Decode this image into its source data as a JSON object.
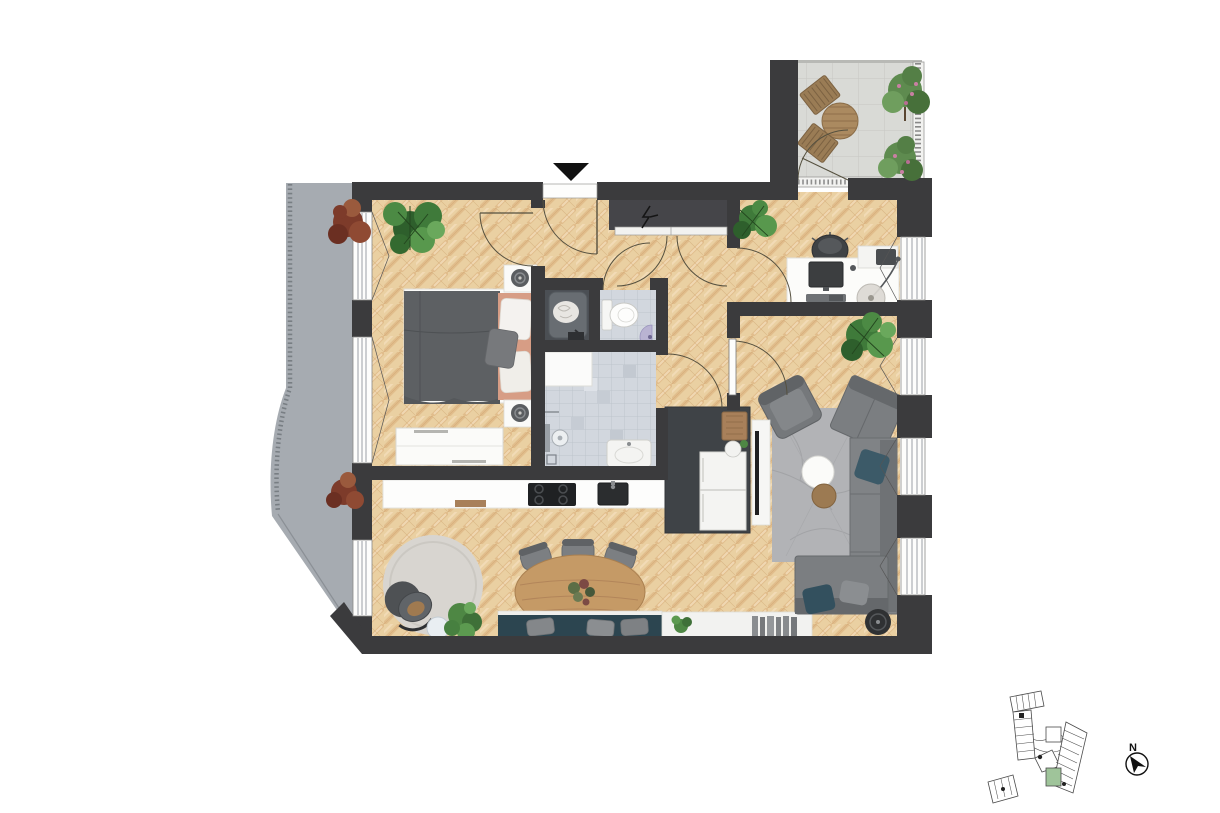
{
  "scene": {
    "type": "apartment-floor-plan-top-view",
    "inset": "building-key-plan-with-highlighted-unit"
  },
  "compass": {
    "label": "N"
  },
  "entrance": {
    "marker": "black-down-triangle"
  },
  "colors": {
    "background": "#ffffff",
    "wall": "#3b3b3d",
    "wood_floor": "#ead0a2",
    "wood_stripe": "#d8ad7a",
    "roof_terrace": "#a6abb1",
    "terrace_tile": "#d9dad6",
    "bath_tile": "#d2d7de",
    "laundry_closet": "#4b4f54",
    "kitchen_block": "#3f4347",
    "bench_teal": "#2c4550",
    "sofa_gray": "#808386",
    "rug_gray": "#b2b3b6",
    "round_rug": "#d8d5d0",
    "bed_duvet": "#5d6063",
    "bed_blanket_salmon": "#d79d85",
    "dining_table_wood": "#c59a66",
    "plant_green": "#4e8744",
    "plant_red": "#7d3b2a",
    "wc_sink_purple": "#b9b3d2",
    "door_arc": "#55503f",
    "keyplan_highlight": "#9fc49a"
  },
  "rooms": {
    "bedroom": [
      "double-bed",
      "nightstand-left",
      "nightstand-right",
      "table-lamp",
      "wardrobe",
      "monstera-plant"
    ],
    "hallway": [
      "entrance-door",
      "utility-closet",
      "electrical-panel"
    ],
    "laundry_closet": [
      "laundry-basket"
    ],
    "wc": [
      "toilet",
      "corner-sink"
    ],
    "bathroom": [
      "shower",
      "shower-head",
      "floor-drain",
      "vanity-counter",
      "sink"
    ],
    "home_office": [
      "desk",
      "monitor",
      "keyboard",
      "office-chair",
      "printer",
      "floor-lamp",
      "plant"
    ],
    "living_room": [
      "corner-sofa",
      "armchair",
      "rug",
      "coffee-table",
      "side-table",
      "tv-sideboard",
      "tv",
      "plant",
      "speaker"
    ],
    "kitchen_dining": [
      "kitchen-counter",
      "cooktop",
      "kitchen-sink",
      "cutting-board",
      "tall-cabinet-fridge-block",
      "island-sink",
      "dining-table",
      "dining-chairs",
      "window-bench",
      "bench-pillows",
      "sideboard",
      "books",
      "round-rug",
      "lounge-chair",
      "side-table",
      "plants"
    ],
    "terrace": [
      "bistro-table",
      "two-chairs",
      "flowering-shrub-top",
      "flowering-shrub-bottom",
      "railing",
      "terrace-door"
    ],
    "roof_area": [
      "red-shrub-top",
      "red-shrub-bottom",
      "perimeter-railing"
    ]
  }
}
